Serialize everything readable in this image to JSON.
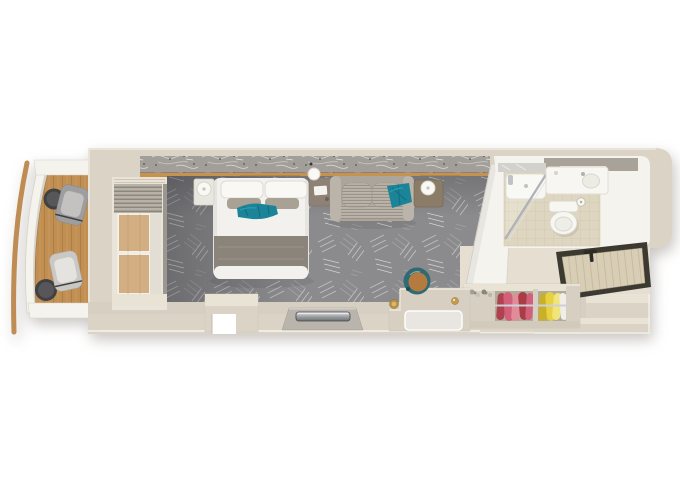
{
  "meta": {
    "description": "Top-down 3D rendered floor plan of a cruise-ship balcony stateroom: private balcony with two lounge chairs and side tables, bedroom with double bed, sofa with teal pillow, vanity desk with acrylic chair, round pouf, wall TV, open wardrobe with pink and yellow clothes, bathroom with shower, toilet and sink, and entry hall with open door.",
    "visible_text": "none"
  },
  "colors": {
    "wall": "#dbd4c6",
    "wallLight": "#e9e3d6",
    "wallDark": "#c7c0b1",
    "floorEdge": "#d7d0c2",
    "entryFloor": "#e6dfd1",
    "white": "#f5f3ee",
    "grayBand": "#a8a299",
    "hull": "#bf8c53",
    "wood": "#c28f52",
    "woodDark": "#9f7239",
    "ledge": "#c6924e",
    "carpet": "#8b8a8d",
    "carpetLine": "#c6c6c9",
    "carpetLite": "#a3a2a6",
    "duvet": "#f2f1ed",
    "pillow": "#f9f8f5",
    "pillowGray": "#a9a194",
    "blanket": "#8b847b",
    "teal": "#1b8498",
    "tealDark": "#11667b",
    "tealLite": "#2fa5b8",
    "sofa": "#aba59b",
    "sofaLite": "#bab4aa",
    "sofaStripe": "#968e83",
    "tableBrown": "#8b7c68",
    "nightBrown": "#8d8275",
    "artBase": "#a29f9a",
    "artLite": "#d7d5d1",
    "artDark": "#56524a",
    "tile": "#ded6c0",
    "tileLine": "#c9c0a4",
    "porcelain": "#f7f6f2",
    "porcelainShade": "#dbd7ca",
    "chrome": "#aeb2b7",
    "metalDark": "#5b5d60",
    "doorWood": "#d8ceb6",
    "doorGrain": "#c3b797",
    "doorFrame": "#3c3931",
    "pink": "#d2607a",
    "pinkDark": "#ae424e",
    "pinkLite": "#e28b99",
    "yellow": "#e7d13e",
    "yellowDark": "#c9b02a",
    "garment": "#f0eee7",
    "leather": "#b57a3f",
    "poufTeal": "#2e6b75",
    "gold": "#c59c4e",
    "chairFabric": "#9e9ea0",
    "chairLight": "#c9c8c5",
    "chairDark": "#414143",
    "curtain": "#b7b1a6",
    "curtainDark": "#7e7970"
  },
  "objects": {
    "balcony": {
      "deck": "teak plank deck",
      "lounge_chairs": 2,
      "side_tables": 2,
      "partitions": 2,
      "railing": "curved white railing",
      "hull_edge": "curved wooden hull strip"
    },
    "bedroom": {
      "bed": "double bed, white duvet, 2 white pillows, 2 grey pillows, teal runner, grey foot blanket",
      "nightstands": 2,
      "wall_sconce": 1,
      "sofa": "ribbed grey two-cushion loveseat with teal accent pillow",
      "sofa_side_table": "brown table with white sphere lamp",
      "sliding_door": "glass balcony door with pleated curtain",
      "tv": "flat TV on wall console opposite bed",
      "desk": "vanity desk with clear acrylic chair, gold bottle, wastebasket",
      "pouf": "round stool, teal sides, tan leather top",
      "carpet": "grey carpet with abstract leaf pattern",
      "headboard": "marbled art band over oak ledge"
    },
    "bathroom": {
      "fixtures": [
        "glass shower with white tray",
        "toilet",
        "toilet-paper holder",
        "sink counter"
      ],
      "floor": "beige mosaic tile"
    },
    "wardrobe": {
      "open_bays": 2,
      "clothes_colors_left": "pink-red",
      "clothes_colors_right": "yellow-white",
      "rod": "chrome hanging rod",
      "counter_items": "toiletry bottles"
    },
    "entry": {
      "door": "open entrance door panel, dark frame, light wood, T handle",
      "hall_floor": "beige"
    }
  }
}
